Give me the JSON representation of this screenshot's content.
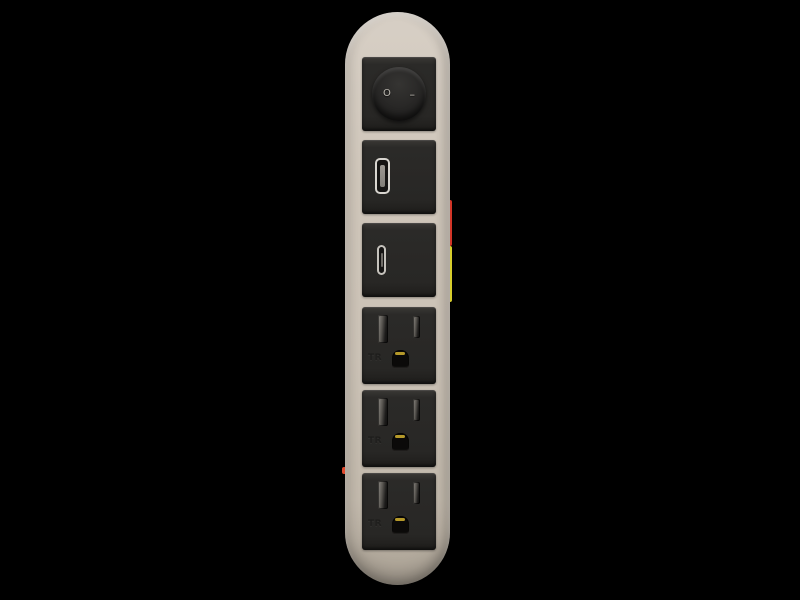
{
  "scene": {
    "background_color": "#000000",
    "subject": "vertical-power-strip-product-render"
  },
  "strip": {
    "body_color": "#cbc2b6",
    "module_color": "#2b2a28",
    "switch": {
      "off_symbol": "O",
      "on_symbol": "–"
    },
    "ports": {
      "usb_a": "usb-a-port",
      "usb_c": "usb-c-port"
    },
    "outlets": [
      {
        "marking": "TR",
        "ground_contact_color": "#b5992a"
      },
      {
        "marking": "TR",
        "ground_contact_color": "#b5992a"
      },
      {
        "marking": "TR",
        "ground_contact_color": "#b5992a"
      }
    ],
    "edge_accents": {
      "right_red": "#d23527",
      "right_yellow": "#d8ce2c",
      "left_red": "#e04a2e"
    }
  }
}
